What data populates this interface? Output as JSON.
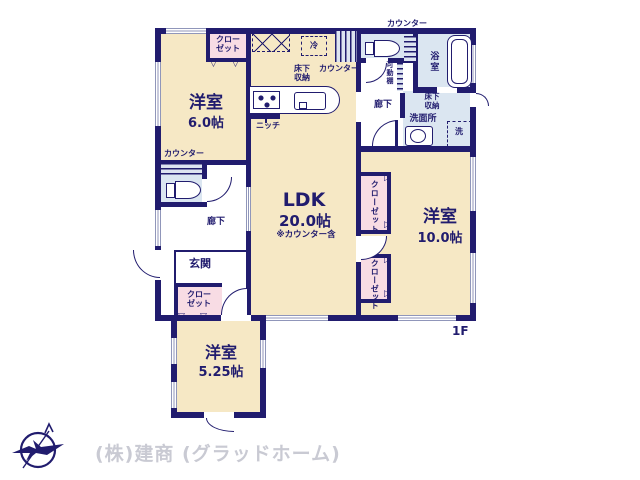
{
  "colors": {
    "wall": "#211c6e",
    "room_tan": "#f6e8c5",
    "closet_pink": "#f8dce4",
    "wet_blue": "#dbe6f1",
    "text_navy": "#211c6e",
    "footer_gray": "#c9cad3"
  },
  "rooms": {
    "bedroom1": {
      "name": "洋室",
      "size": "6.0帖"
    },
    "ldk": {
      "name": "LDK",
      "size": "20.0帖",
      "note": "※カウンター含"
    },
    "bedroom2": {
      "name": "洋室",
      "size": "10.0帖"
    },
    "bedroom3": {
      "name": "洋室",
      "size": "5.25帖"
    },
    "entrance": {
      "name": "玄関"
    },
    "hall_left": {
      "name": "廊下"
    },
    "hall_top": {
      "name": "廊下"
    },
    "bath": {
      "name": "浴室"
    },
    "washroom": {
      "name": "洗面所"
    }
  },
  "labels": {
    "closet": "クローゼット",
    "closet_l1": "クロー",
    "closet_l2": "ゼット",
    "counter": "カウンター",
    "underfloor_l1": "床下",
    "underfloor_l2": "収納",
    "fridge": "冷",
    "niche": "ニッチ",
    "movable_shelf": "可動棚",
    "washer": "洗",
    "floor": "1F"
  },
  "footer": {
    "company": "(株)建商 (グラッドホーム)"
  }
}
